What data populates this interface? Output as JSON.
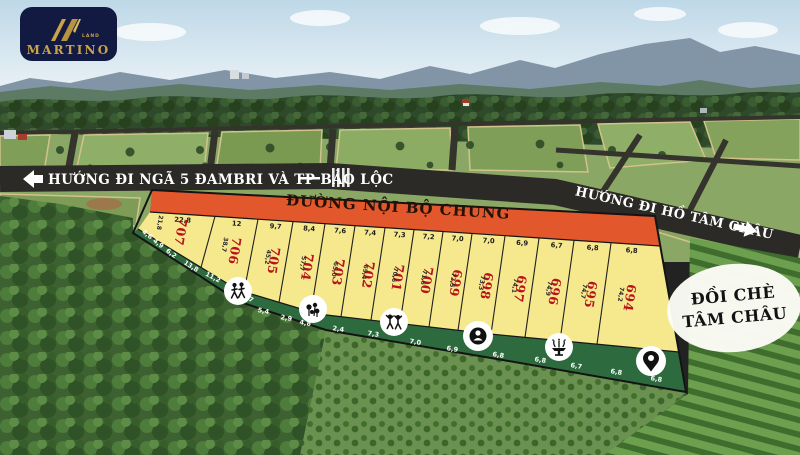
{
  "logo": {
    "brand": "MARTINO",
    "sub": "LAND"
  },
  "road_labels": {
    "left": "HƯỚNG ĐI NGÃ 5 ĐAMBRI VÀ TP BẢO LỘC",
    "right": "HƯỚNG ĐI HỒ TÂM CHÂU",
    "internal": "ĐƯỜNG NỘI BỘ CHUNG"
  },
  "landmark": {
    "line1": "ĐỒI CHÈ",
    "line2": "TÂM CHÂU"
  },
  "plots": [
    {
      "number": "707",
      "top": "22,8",
      "side": "21,8"
    },
    {
      "number": "706",
      "top": "12",
      "side": "38,7"
    },
    {
      "number": "705",
      "top": "9,7",
      "side": "45,2"
    },
    {
      "number": "704",
      "top": "8,4",
      "side": "57,7"
    },
    {
      "number": "703",
      "top": "7,6",
      "side": "65,0"
    },
    {
      "number": "702",
      "top": "7,4",
      "side": "69,4"
    },
    {
      "number": "701",
      "top": "7,3",
      "side": "70,6"
    },
    {
      "number": "700",
      "top": "7,2",
      "side": "71,6"
    },
    {
      "number": "699",
      "top": "7,0",
      "side": "72,5"
    },
    {
      "number": "698",
      "top": "7,0",
      "side": "73,3"
    },
    {
      "number": "697",
      "top": "6,9",
      "side": "74,1"
    },
    {
      "number": "696",
      "top": "6,7",
      "side": "74,9"
    },
    {
      "number": "695",
      "top": "6,8",
      "side": "74,7"
    },
    {
      "number": "694",
      "top": "6,8",
      "side": "74,2"
    }
  ],
  "green_strip": {
    "edge_numbers": [
      "4,6",
      "4,9",
      "6,2",
      "13,8",
      "11,2",
      "9,7",
      "5,4",
      "2,9",
      "4,8",
      "2,4",
      "7,3",
      "7,0",
      "6,9",
      "6,8",
      "6,8",
      "6,7",
      "6,8",
      "6,8"
    ],
    "icons": [
      {
        "name": "people-walking-icon"
      },
      {
        "name": "flowers-icon"
      },
      {
        "name": "children-playing-icon"
      },
      {
        "name": "statue-icon"
      },
      {
        "name": "fountain-icon"
      },
      {
        "name": "location-pin-icon"
      }
    ]
  },
  "colors": {
    "orange_road": "#e2572b",
    "plot_fill": "#f6e88c",
    "plot_number": "#b8121a",
    "green_strip": "#2d6b3f",
    "road_dark": "#2b2a26",
    "logo_navy": "#131a41",
    "logo_gold": "#c9a24a"
  }
}
